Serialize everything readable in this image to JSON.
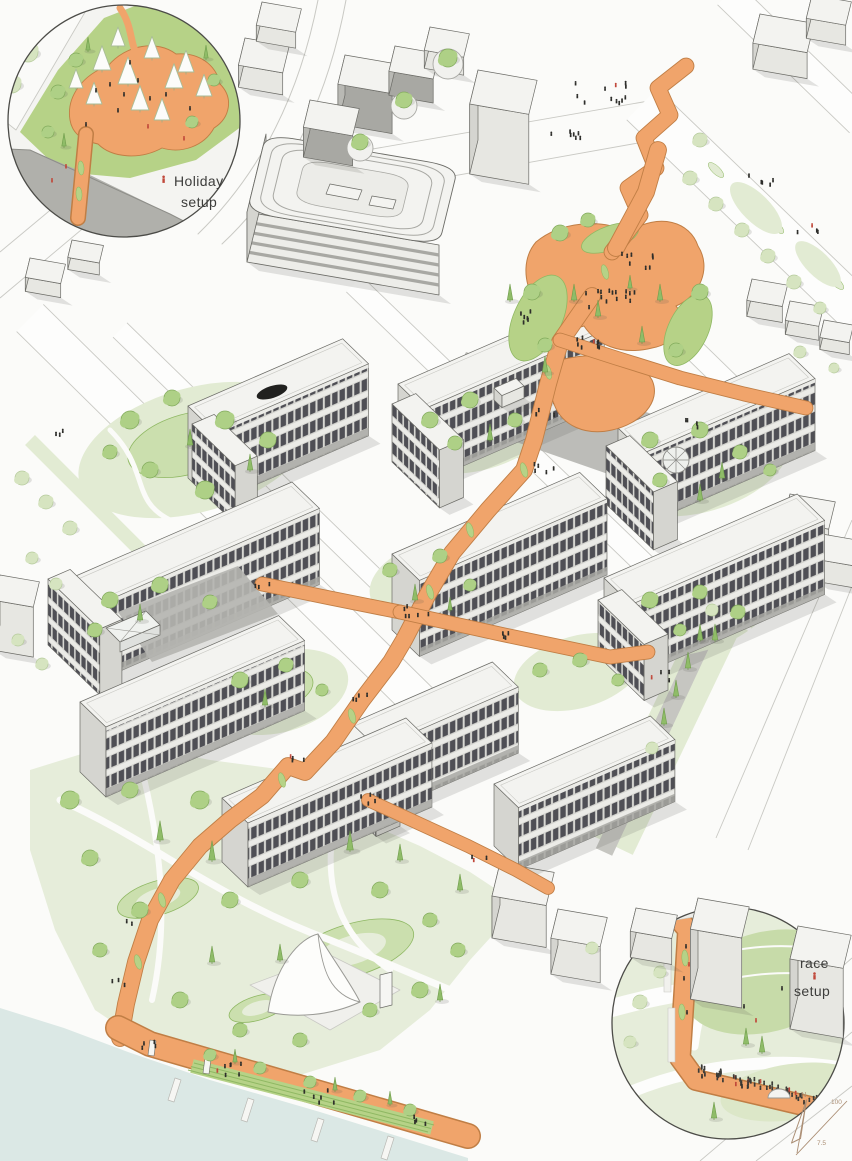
{
  "title": "Axonometric campus masterplan illustration",
  "labels": {
    "holiday_inset": {
      "line1": "Holiday",
      "line2": "setup"
    },
    "race_inset": {
      "line1": "race",
      "line2": "setup"
    }
  },
  "compass": {
    "north": "N"
  },
  "scale": {
    "top": "100",
    "bottom": "7.5"
  },
  "icons": {
    "north_arrow": "outlined needle arrow pointing north",
    "holiday_marker": "small red person silhouette",
    "race_marker": "small red person silhouette"
  },
  "colors": {
    "bg": "#fbfbf9",
    "outline": "#6b6b66",
    "line": "#c9c9c4",
    "roadWhite": "#fdfdfc",
    "roofWhite": "#f3f3f0",
    "faceLight": "#e7e7e2",
    "faceMid": "#d5d5d0",
    "faceDark": "#a8a8a3",
    "ground": "#b5b5b0",
    "grayRoad": "#b0b0ab",
    "facadeFrame": "#d7d7d2",
    "facadeSpandrel": "#ebebe7",
    "windowDark": "#4f4f55",
    "orange": "#f0a46b",
    "orangeEdge": "#c07e45",
    "lawn": "#b6d287",
    "lawnEdge": "#8fb863",
    "courtyard": "#cbdfae",
    "paleGreen": "#e2ebd3",
    "parkGreen": "#e6edda",
    "slopeGreen": "#c7dba9",
    "treeGreen": "#aed086",
    "treeEdge": "#82ab5c",
    "paleTree": "#d6e4c0",
    "paleTreeEdge": "#b6cb9c",
    "cypress": "#8fbc68",
    "cypressEdge": "#6f9c4b",
    "water": "#dbe8e5",
    "pond": "#21211f",
    "shadow": "rgba(90,90,80,0.16)",
    "people": "#2d2d2a",
    "peopleRed": "#c0483a",
    "compassTan": "#ab8e74",
    "label": "#3d3d3b"
  }
}
